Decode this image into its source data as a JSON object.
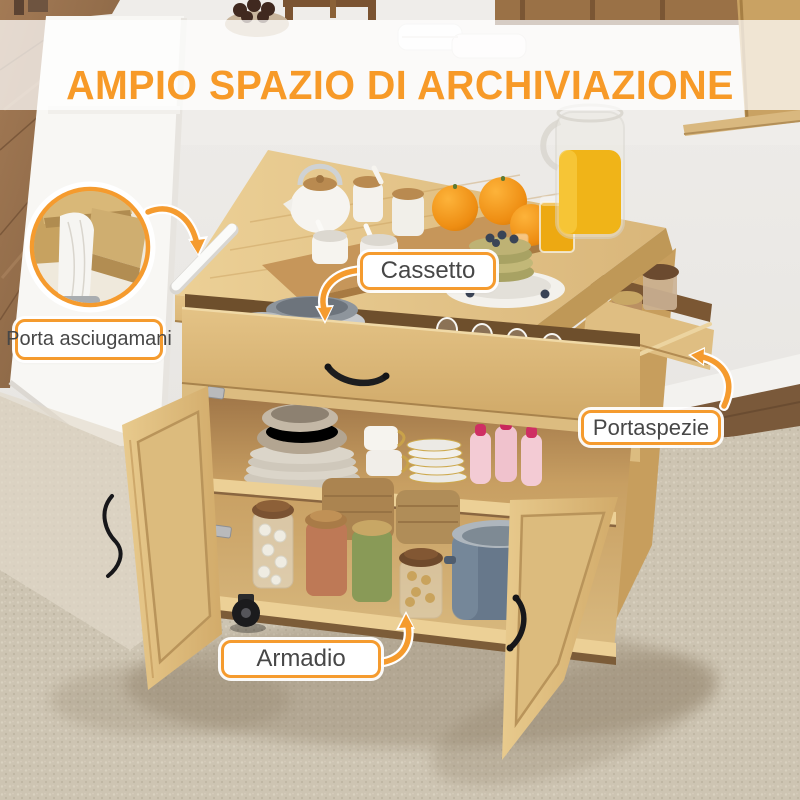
{
  "title": {
    "text": "AMPIO SPAZIO DI ARCHIVIAZIONE"
  },
  "colors": {
    "accent": "#F59B2E",
    "title": "#F79A28",
    "label_text": "#474747"
  },
  "callouts": {
    "cassetto": "Cassetto",
    "porta_asciugamani": "Porta asciugamani",
    "portaspezie": "Portaspezie",
    "armadio": "Armadio"
  }
}
